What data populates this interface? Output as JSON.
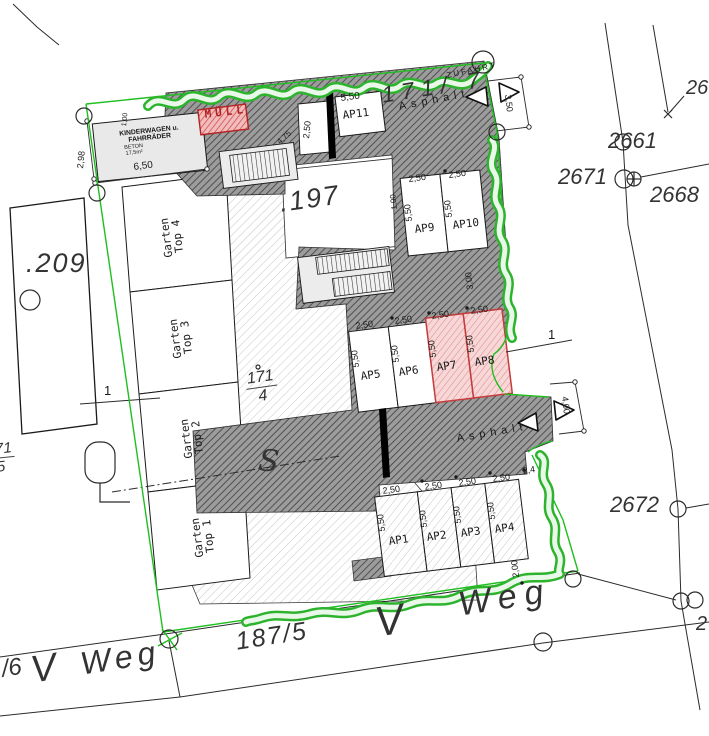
{
  "title": "Lageplan / site plan",
  "parcels": {
    "p197": ".197",
    "p209": ".209",
    "p171_4_num": "171",
    "p171_4_den": "4",
    "p171_7": "171/ 7",
    "p171_5_num": "171",
    "p171_5_den": "5",
    "p187_5": "187/5",
    "p2661": "2661",
    "p2671": "2671",
    "p2668": "2668",
    "p2672": "2672",
    "p26_partial": "26",
    "p2_partial": "2",
    "p6_partial": "/6",
    "weg_main": "Weg",
    "weg_left": "Weg",
    "v_main": "V",
    "v_left": "V"
  },
  "labels": {
    "kinderwagen_title": "KINDERWAGEN u. FAHRRÄDER",
    "kinderwagen_sub1": "BETON",
    "kinderwagen_sub2": "17,5m²",
    "muell": "MÜLL",
    "zufahrt": "ZUFAHRT",
    "asphalt_top": "Asphalt",
    "asphalt_bottom": "Asphalt",
    "s_marker": "S",
    "section_left": "1",
    "section_right": "1"
  },
  "dimensions": {
    "d650": "6,50",
    "d298": "2,98",
    "d100_top": "1,00",
    "d475": "4,75",
    "d350": "3,50",
    "d300": "3,00",
    "d100_mid": "1,00",
    "d400": "4,00",
    "d240": "2,4",
    "d200": "2,00"
  },
  "gardens": [
    {
      "line1": "Garten",
      "line2": "Top 4"
    },
    {
      "line1": "Garten",
      "line2": "Top 3"
    },
    {
      "line1": "Garten",
      "line2": "Top 2"
    },
    {
      "line1": "Garten",
      "line2": "Top 1"
    }
  ],
  "parking": [
    {
      "id": "AP1",
      "width": "2,50",
      "depth": "5,50",
      "highlighted": false
    },
    {
      "id": "AP2",
      "width": "2,50",
      "depth": "5,50",
      "highlighted": false
    },
    {
      "id": "AP3",
      "width": "2,50",
      "depth": "5,50",
      "highlighted": false
    },
    {
      "id": "AP4",
      "width": "2,50",
      "depth": "5,50",
      "highlighted": false
    },
    {
      "id": "AP5",
      "width": "2,50",
      "depth": "5,50",
      "highlighted": false
    },
    {
      "id": "AP6",
      "width": "2,50",
      "depth": "5,50",
      "highlighted": false
    },
    {
      "id": "AP7",
      "width": "2,50",
      "depth": "5,50",
      "highlighted": true
    },
    {
      "id": "AP8",
      "width": "2,50",
      "depth": "5,50",
      "highlighted": true
    },
    {
      "id": "AP9",
      "width": "2,50",
      "depth": "5,50",
      "highlighted": false
    },
    {
      "id": "AP10",
      "width": "2,50",
      "depth": "5,50",
      "highlighted": false
    },
    {
      "id": "AP11",
      "width": "2,50",
      "depth": "5,50",
      "highlighted": false
    }
  ],
  "colors": {
    "boundary_green": "#1fbf1f",
    "hedge_green": "#2db32d",
    "highlight_red": "#c43c3c",
    "asphalt_gray": "#9c9c9c"
  }
}
